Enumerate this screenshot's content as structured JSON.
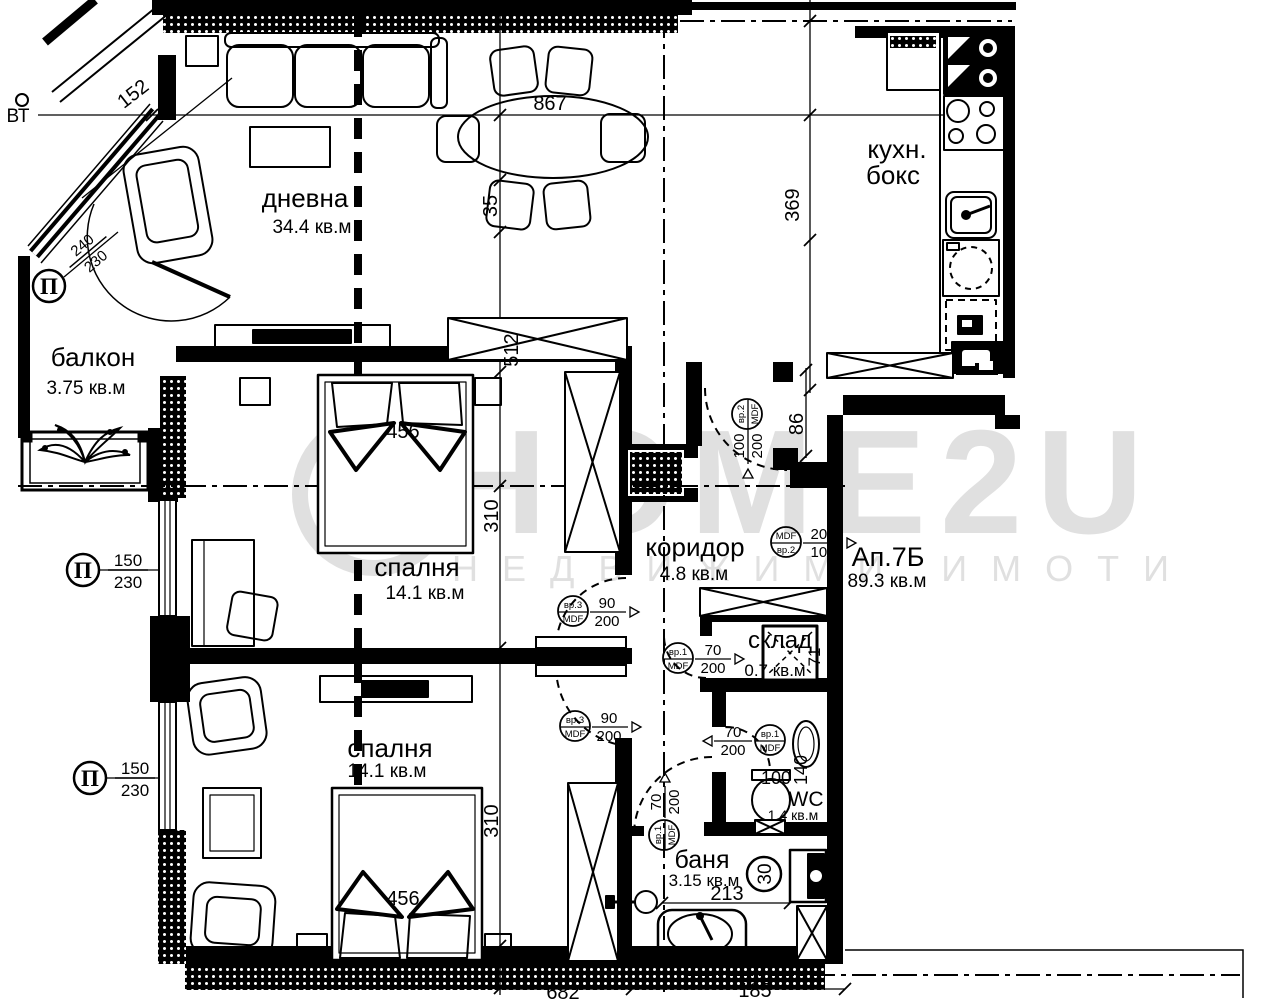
{
  "watermark": {
    "brand": "HOME2U",
    "tagline": "НЕДВИЖИМИ ИМОТИ"
  },
  "apartment": {
    "name": "Ап.7Б",
    "area": "89.3 кв.м"
  },
  "rooms": {
    "living": {
      "name": "дневна",
      "area": "34.4 кв.м"
    },
    "kitchen": {
      "name_line1": "кухн.",
      "name_line2": "бокс"
    },
    "balcony": {
      "name": "балкон",
      "area": "3.75 кв.м"
    },
    "bedroom1": {
      "name": "спалня",
      "area": "14.1 кв.м"
    },
    "bedroom2": {
      "name": "спалня",
      "area": "14.1 кв.м"
    },
    "corridor": {
      "name": "коридор",
      "area": "4.8 кв.м"
    },
    "storage": {
      "name": "склад",
      "area": "0.7 кв.м"
    },
    "wc": {
      "name": "WC",
      "area": "1.4 кв.м"
    },
    "bath": {
      "name": "баня",
      "area": "3.15 кв.м"
    }
  },
  "dimensions": {
    "top_width": "867",
    "table_gap": "35",
    "wall_offset": "512",
    "kitchen_depth": "369",
    "balcony_width": "152",
    "bed1_width": "456",
    "bed2_width": "456",
    "bedroom1_depth": "310",
    "bedroom2_depth": "310",
    "entry_opening": "86",
    "storage_width": "71",
    "wc_width": "100",
    "wc_depth": "140",
    "bath_width": "213",
    "bath_fixture": "30",
    "bottom_a": "682",
    "bottom_b": "185"
  },
  "window_tags": [
    {
      "symbol": "П",
      "num": "240",
      "den": "230"
    },
    {
      "symbol": "П",
      "num": "150",
      "den": "230"
    },
    {
      "symbol": "П",
      "num": "150",
      "den": "230"
    }
  ],
  "door_tags": [
    {
      "top": "вр.2",
      "bottom": "MDF",
      "num": "100",
      "den": "200"
    },
    {
      "top": "MDF",
      "bottom": "вр.2",
      "num": "200",
      "den": "100"
    },
    {
      "top": "вр.3",
      "bottom": "MDF",
      "num": "90",
      "den": "200"
    },
    {
      "top": "вр.3",
      "bottom": "MDF",
      "num": "90",
      "den": "200"
    },
    {
      "top": "вр.1",
      "bottom": "MDF",
      "num": "70",
      "den": "200"
    },
    {
      "top": "вр.1",
      "bottom": "MDF",
      "num": "70",
      "den": "200"
    },
    {
      "top": "вр.1",
      "bottom": "MDF",
      "num": "70",
      "den": "200"
    }
  ],
  "annotations": {
    "vt": "ВТ"
  }
}
